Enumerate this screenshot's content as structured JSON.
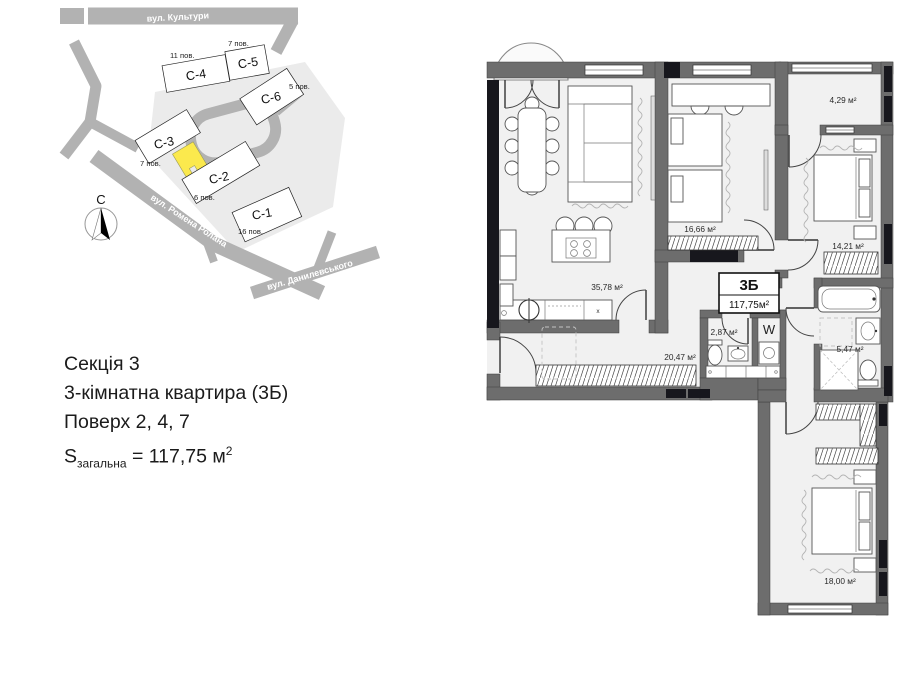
{
  "site": {
    "streets": [
      {
        "name": "вул. Культури"
      },
      {
        "name": "вул. Ромена Ролана"
      },
      {
        "name": "вул. Данилевського"
      }
    ],
    "buildings": [
      {
        "label": "C-4",
        "floors": "11 пов."
      },
      {
        "label": "C-5",
        "floors": "7 пов."
      },
      {
        "label": "C-6",
        "floors": "5 пов."
      },
      {
        "label": "C-3",
        "floors": "7 пов."
      },
      {
        "label": "C-2",
        "floors": "6 пов."
      },
      {
        "label": "C-1",
        "floors": "16 пов."
      }
    ],
    "compass": "С",
    "colors": {
      "road": "#b2b2b2",
      "parcel": "#ebebeb",
      "building_c3": "#f6f4cc",
      "unit_marker": "#fbe94d"
    }
  },
  "info": {
    "line1": "Секція 3",
    "line2": "3-кімнатна квартира (3Б)",
    "line3": "Поверх 2, 4, 7",
    "s": "S",
    "s_sub": "загальна",
    "s_value": " = 117,75 м",
    "s_sup": "2"
  },
  "plan": {
    "unit": {
      "code": "3Б",
      "area": "117,75м²"
    },
    "washer": "W",
    "kitchen_marker": "x",
    "rooms": [
      {
        "name": "kitchen-living",
        "area": "35,78 м²"
      },
      {
        "name": "bedroom-1",
        "area": "16,66 м²"
      },
      {
        "name": "balcony",
        "area": "4,29 м²"
      },
      {
        "name": "bedroom-2",
        "area": "14,21 м²"
      },
      {
        "name": "bathroom",
        "area": "5,47 м²"
      },
      {
        "name": "hallway",
        "area": "20,47 м²"
      },
      {
        "name": "wc",
        "area": "2,87 м²"
      },
      {
        "name": "bedroom-3",
        "area": "18,00 м²"
      }
    ],
    "colors": {
      "wall": "#6d6d6d",
      "floor": "#f1f1f1",
      "glazing": "#17171d"
    }
  }
}
